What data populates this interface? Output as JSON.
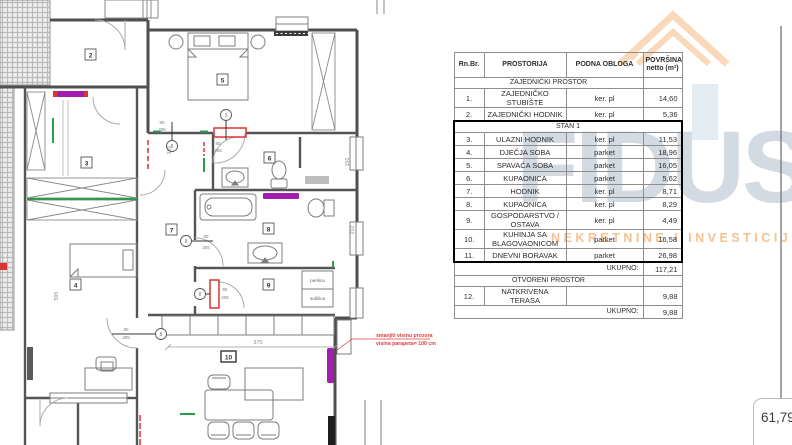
{
  "watermark": {
    "brand": "FIDUS",
    "tagline": "NEKRETNINE I INVESTICIJE",
    "brand_color": "#a7b5c3",
    "tagline_color": "#f2984a",
    "logo_roof_color": "#ef8b2d",
    "logo_window_color": "#a9c4da"
  },
  "table": {
    "headers": {
      "num": "Rn.Br.",
      "room": "PROSTORIJA",
      "floor": "PODNA  OBLOGA",
      "area_line1": "POVRŠINA",
      "area_line2": "netto (m²)"
    },
    "rows": [
      {
        "type": "section",
        "label": "ZAJEDNIČKI PROSTOR"
      },
      {
        "type": "room",
        "num": "1.",
        "name": "ZAJEDNIČKO STUBIŠTE",
        "floor": "ker. pl",
        "area": "14,60"
      },
      {
        "type": "room",
        "num": "2.",
        "name": "ZAJEDNIČKI HODNIK",
        "floor": "ker. pl",
        "area": "5,36"
      },
      {
        "type": "section",
        "label": "STAN 1",
        "stan": true,
        "full": true
      },
      {
        "type": "room",
        "num": "3.",
        "name": "ULAZNI HODNIK",
        "floor": "ker. pl",
        "area": "11,53",
        "stan": true
      },
      {
        "type": "room",
        "num": "4.",
        "name": "DJEČJA SOBA",
        "floor": "parket",
        "area": "18,96",
        "stan": true
      },
      {
        "type": "room",
        "num": "5.",
        "name": "SPAVAĆA SOBA",
        "floor": "parket",
        "area": "16,05",
        "stan": true
      },
      {
        "type": "room",
        "num": "6.",
        "name": "KUPAONICA",
        "floor": "parket",
        "area": "5,62",
        "stan": true
      },
      {
        "type": "room",
        "num": "7.",
        "name": "HODNIK",
        "floor": "ker. pl",
        "area": "8,71",
        "stan": true
      },
      {
        "type": "room",
        "num": "8.",
        "name": "KUPAONICA",
        "floor": "ker. pl",
        "area": "8,29",
        "stan": true
      },
      {
        "type": "room",
        "num": "9.",
        "name": "GOSPODARSTVO / OSTAVA",
        "floor": "ker. pl",
        "area": "4,49",
        "stan": true
      },
      {
        "type": "room",
        "num": "10.",
        "name": "KUHINJA SA BLAGOVAONICOM",
        "floor": "parket",
        "area": "16,58",
        "stan": true
      },
      {
        "type": "room",
        "num": "11.",
        "name": "DNEVNI BORAVAK",
        "floor": "parket",
        "area": "26,98",
        "stan": true,
        "last": true
      },
      {
        "type": "total",
        "label": "UKUPNO:",
        "area": "117,21"
      },
      {
        "type": "section",
        "label": "OTVORENI PROSTOR"
      },
      {
        "type": "room",
        "num": "12.",
        "name": "NATKRIVENA TERASA",
        "floor": "",
        "area": "9,88"
      },
      {
        "type": "total",
        "label": "UKUPNO:",
        "area": "9,88"
      }
    ]
  },
  "plan": {
    "room_labels": [
      "2",
      "3",
      "4",
      "5",
      "6",
      "7",
      "8",
      "9",
      "10"
    ],
    "dimensions": {
      "d320": "320",
      "d595": "595",
      "d150": "150",
      "d210": "210",
      "d370": "370",
      "door_w": "80",
      "door_h": "205"
    },
    "door_markers": {
      "m_default": "8",
      "m_three": "3"
    },
    "appliance": {
      "line1": "perilica",
      "line2": "sušilica"
    },
    "annotation": {
      "line1": "smanjiti visinu prozora",
      "line2": "visina parapeta= 100 cm",
      "color": "#e03c3c"
    },
    "colors": {
      "radiator": "#a21caf",
      "change_red": "#dd3333",
      "install_green": "#2a9d4a"
    }
  },
  "area_note": "61,79"
}
